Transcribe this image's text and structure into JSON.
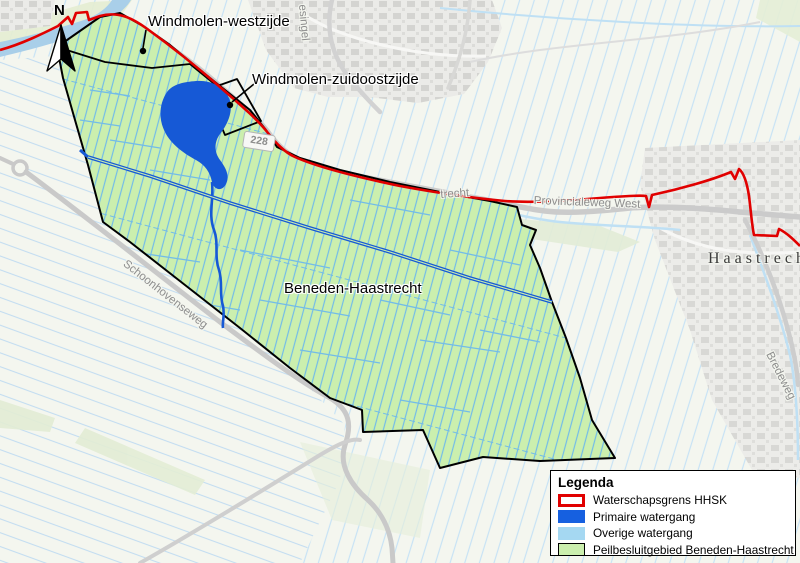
{
  "map": {
    "north_arrow_label": "N",
    "road_shield": "228",
    "area_labels": {
      "windmolen_west": "Windmolen-westzijde",
      "windmolen_zuidoost": "Windmolen-zuidoostzijde",
      "beneden_haastrecht": "Beneden-Haastrecht"
    },
    "road_labels": {
      "singel": "esingel",
      "trecht": "trecht",
      "provincialeweg": "Provincialeweg West",
      "schoonhovenseweg": "Schoonhovenseweg",
      "bredeweg": "Bredeweg"
    },
    "place_labels": {
      "haastrecht": "Haastrecht"
    },
    "colors": {
      "boundary_red": "#e10000",
      "primary_water": "#1659d6",
      "other_water": "#a5d8f2",
      "area_green": "#cbefae"
    }
  },
  "legend": {
    "title": "Legenda",
    "items": [
      {
        "label": "Waterschapsgrens HHSK",
        "color": "#e10000",
        "style": "outline"
      },
      {
        "label": "Primaire watergang",
        "color": "#1660e0",
        "style": "fill"
      },
      {
        "label": "Overige watergang",
        "color": "#a5d8f2",
        "style": "fill"
      },
      {
        "label": "Peilbesluitgebied Beneden-Haastrecht",
        "color": "#cbefae",
        "style": "fill-outline"
      }
    ]
  }
}
